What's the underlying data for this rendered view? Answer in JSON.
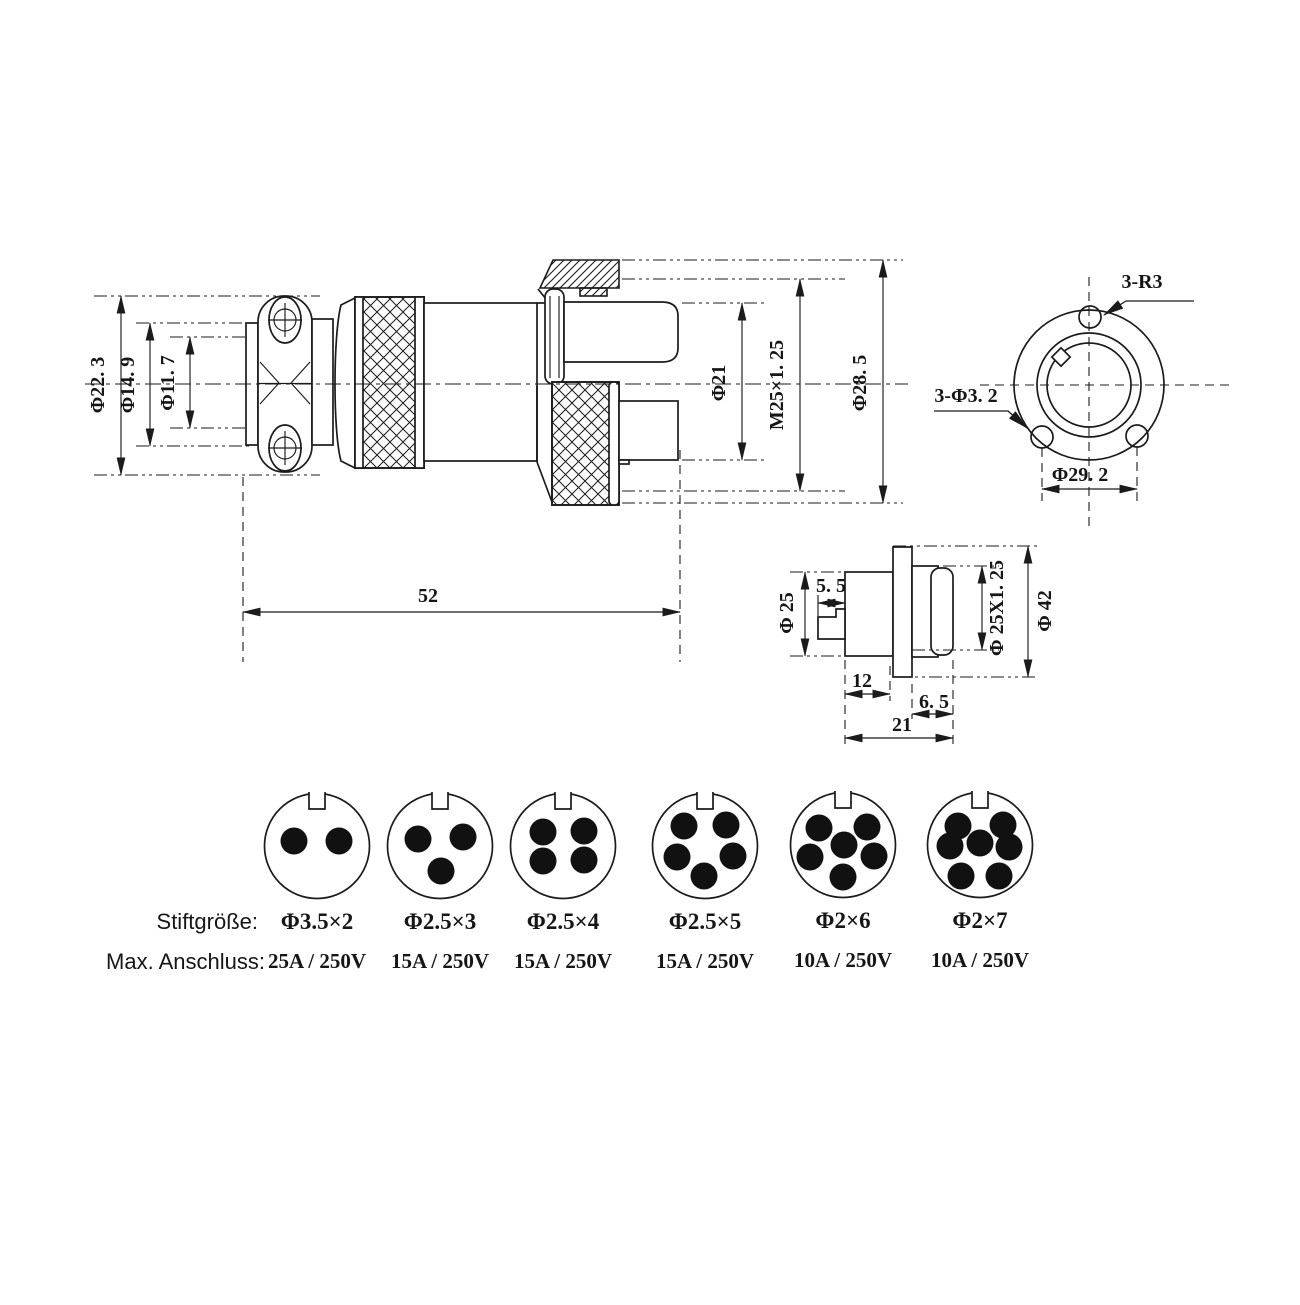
{
  "main_view": {
    "dim_labels": {
      "outer": "Φ22. 3",
      "mid": "Φ14. 9",
      "inner": "Φ11. 7",
      "body": "Φ21",
      "thread": "M25×1. 25",
      "nut": "Φ28. 5",
      "length": "52"
    }
  },
  "front_view": {
    "labels": {
      "notches": "3-R3",
      "holes": "3-Φ3. 2",
      "bolt_circle": "Φ29. 2"
    }
  },
  "side_view": {
    "dim_labels": {
      "front_dia": "Φ 25",
      "tab_width": "5. 5",
      "thread": "Φ 25X1. 25",
      "flange_dia": "Φ 42",
      "front_len": "12",
      "rear_len": "6. 5",
      "total_len": "21"
    }
  },
  "pin_table": {
    "row_labels": {
      "pin_size": "Stiftgröße:",
      "max_rating": "Max. Anschluss:"
    },
    "connectors": [
      {
        "pins": 2,
        "pin_size": "Φ3.5×2",
        "rating": "25A / 250V"
      },
      {
        "pins": 3,
        "pin_size": "Φ2.5×3",
        "rating": "15A / 250V"
      },
      {
        "pins": 4,
        "pin_size": "Φ2.5×4",
        "rating": "15A / 250V"
      },
      {
        "pins": 5,
        "pin_size": "Φ2.5×5",
        "rating": "15A / 250V"
      },
      {
        "pins": 6,
        "pin_size": "Φ2×6",
        "rating": "10A / 250V"
      },
      {
        "pins": 7,
        "pin_size": "Φ2×7",
        "rating": "10A / 250V"
      }
    ]
  },
  "colors": {
    "ink": "#1b1b1b",
    "paper": "#ffffff"
  }
}
